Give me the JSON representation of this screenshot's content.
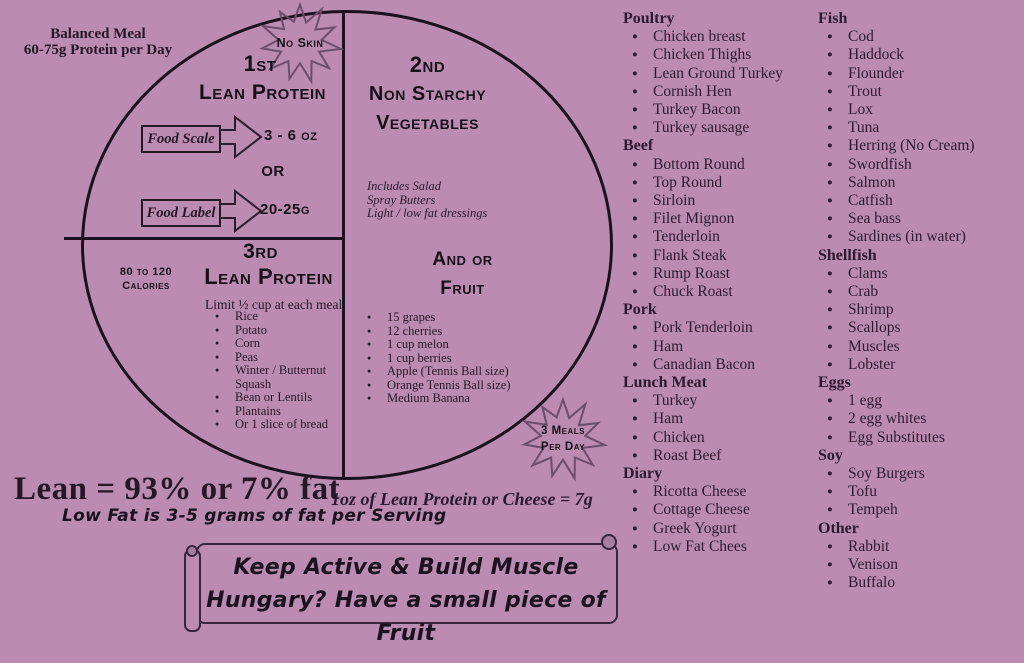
{
  "colors": {
    "background": "#bc8bb1",
    "ink": "#241727",
    "line": "#1b1120",
    "burst_outline": "#6d4c6c",
    "banner_outline": "#3a2540"
  },
  "header": {
    "title_line1": "Balanced Meal",
    "title_line2": "60-75g Protein per Day"
  },
  "plate": {
    "no_skin_badge": "No Skin",
    "meals_badge_line1": "3 Meals",
    "meals_badge_line2": "Per Day",
    "section1": {
      "rank": "1st",
      "title": "Lean Protein",
      "row1_label": "Food Scale",
      "row1_value": "3 - 6 oz",
      "or_label": "OR",
      "row2_label": "Food Label",
      "row2_value": "20-25g"
    },
    "section2": {
      "rank": "2nd",
      "title_line1": "Non Starchy",
      "title_line2": "Vegetables",
      "notes": [
        "Includes Salad",
        "Spray Butters",
        "Light / low fat dressings"
      ],
      "subtitle_line1": "And or",
      "subtitle_line2": "Fruit",
      "fruit_items": [
        "15 grapes",
        "12 cherries",
        "1 cup melon",
        "1 cup berries",
        "Apple (Tennis Ball size)",
        "Orange Tennis Ball size)",
        "Medium Banana"
      ]
    },
    "section3": {
      "rank": "3rd",
      "title": "Lean Protein",
      "calories_line1": "80 to 120",
      "calories_line2": "Calories",
      "limit": "Limit ½ cup at each meal",
      "items": [
        "Rice",
        "Potato",
        "Corn",
        "Peas",
        "Winter / Butternut Squash",
        "Bean or Lentils",
        "Plantains",
        "Or 1 slice of bread"
      ]
    }
  },
  "footnotes": {
    "lean": "Lean = 93% or 7% fat",
    "cheese": "1oz of Lean Protein or Cheese = 7g",
    "low_fat": "Low Fat is 3-5 grams of fat per Serving"
  },
  "banner": {
    "line1": "Keep Active & Build Muscle",
    "line2": "Hungary? Have a small piece of Fruit"
  },
  "food_lists": {
    "column1": [
      {
        "category": "Poultry",
        "items": [
          "Chicken breast",
          "Chicken Thighs",
          "Lean Ground Turkey",
          "Cornish Hen",
          "Turkey Bacon",
          "Turkey sausage"
        ]
      },
      {
        "category": "Beef",
        "items": [
          "Bottom Round",
          "Top Round",
          "Sirloin",
          "Filet Mignon",
          "Tenderloin",
          "Flank Steak",
          "Rump Roast",
          "Chuck Roast"
        ]
      },
      {
        "category": "Pork",
        "items": [
          "Pork Tenderloin",
          "Ham",
          "Canadian Bacon"
        ]
      },
      {
        "category": "Lunch Meat",
        "items": [
          "Turkey",
          "Ham",
          "Chicken",
          "Roast Beef"
        ]
      },
      {
        "category": "Diary",
        "items": [
          "Ricotta Cheese",
          "Cottage Cheese",
          "Greek Yogurt",
          "Low Fat Chees"
        ]
      }
    ],
    "column2": [
      {
        "category": "Fish",
        "items": [
          "Cod",
          "Haddock",
          "Flounder",
          "Trout",
          "Lox",
          "Tuna",
          "Herring (No Cream)",
          "Swordfish",
          "Salmon",
          "Catfish",
          "Sea bass",
          "Sardines (in water)"
        ]
      },
      {
        "category": "Shellfish",
        "items": [
          "Clams",
          "Crab",
          "Shrimp",
          "Scallops",
          "Muscles",
          "Lobster"
        ]
      },
      {
        "category": "Eggs",
        "items": [
          "1 egg",
          "2 egg whites",
          "Egg Substitutes"
        ]
      },
      {
        "category": "Soy",
        "items": [
          "Soy Burgers",
          "Tofu",
          "Tempeh"
        ]
      },
      {
        "category": "Other",
        "items": [
          "Rabbit",
          "Venison",
          "Buffalo"
        ]
      }
    ]
  }
}
